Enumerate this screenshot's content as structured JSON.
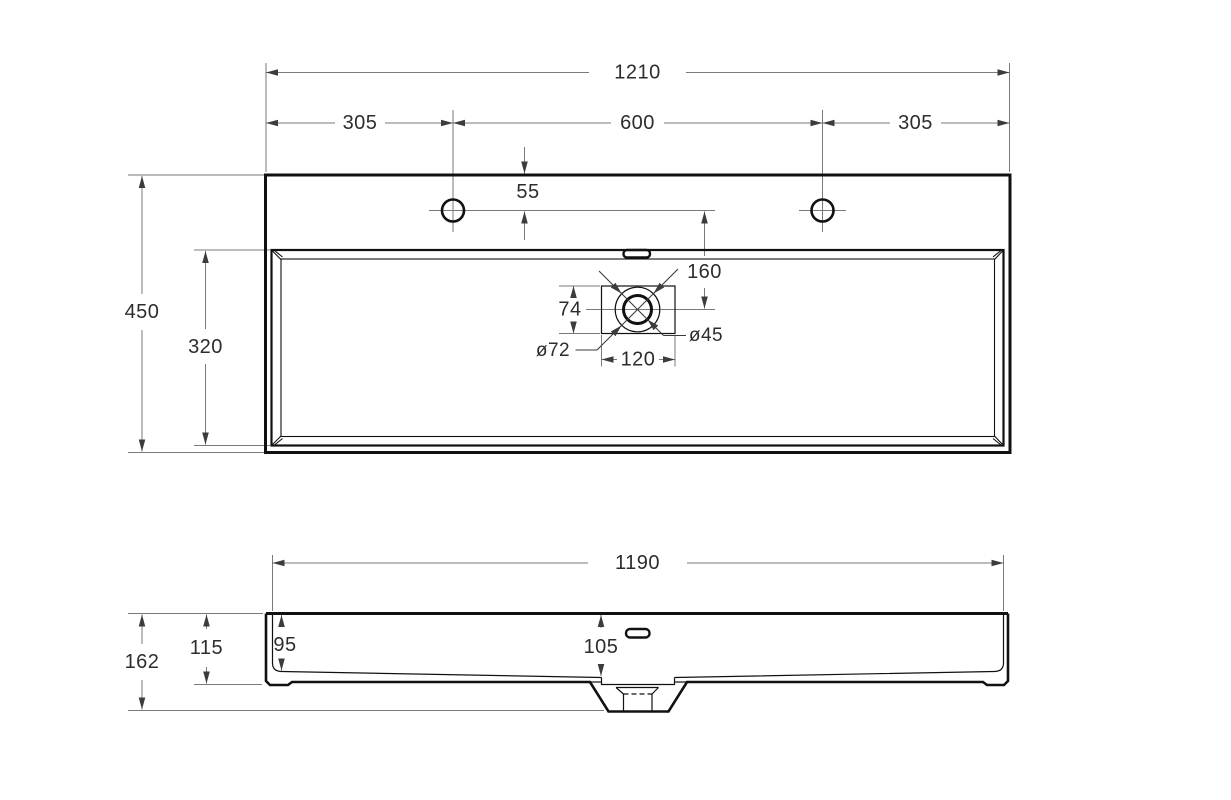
{
  "drawing": {
    "type": "technical-dimension-drawing",
    "subject": "rectangular washbasin, plan view and front elevation",
    "colors": {
      "background": "#ffffff",
      "object_line": "#111111",
      "dimension_line": "#7a7a7a",
      "text": "#2d2d2d"
    },
    "top_view": {
      "dims": {
        "overall_width": "1210",
        "left_faucet_offset": "305",
        "faucet_spacing": "600",
        "right_faucet_offset": "305",
        "faucet_from_back_edge": "55",
        "faucet_to_drain": "160",
        "overall_depth": "450",
        "bowl_depth": "320",
        "drain_recess_height": "74",
        "drain_recess_width": "120",
        "drain_outer_diameter": "ø72",
        "drain_inner_diameter": "ø45"
      }
    },
    "front_view": {
      "dims": {
        "inner_width": "1190",
        "total_height": "162",
        "body_height": "115",
        "bowl_depth_at_side": "95",
        "bowl_depth_at_drain": "105"
      }
    }
  }
}
